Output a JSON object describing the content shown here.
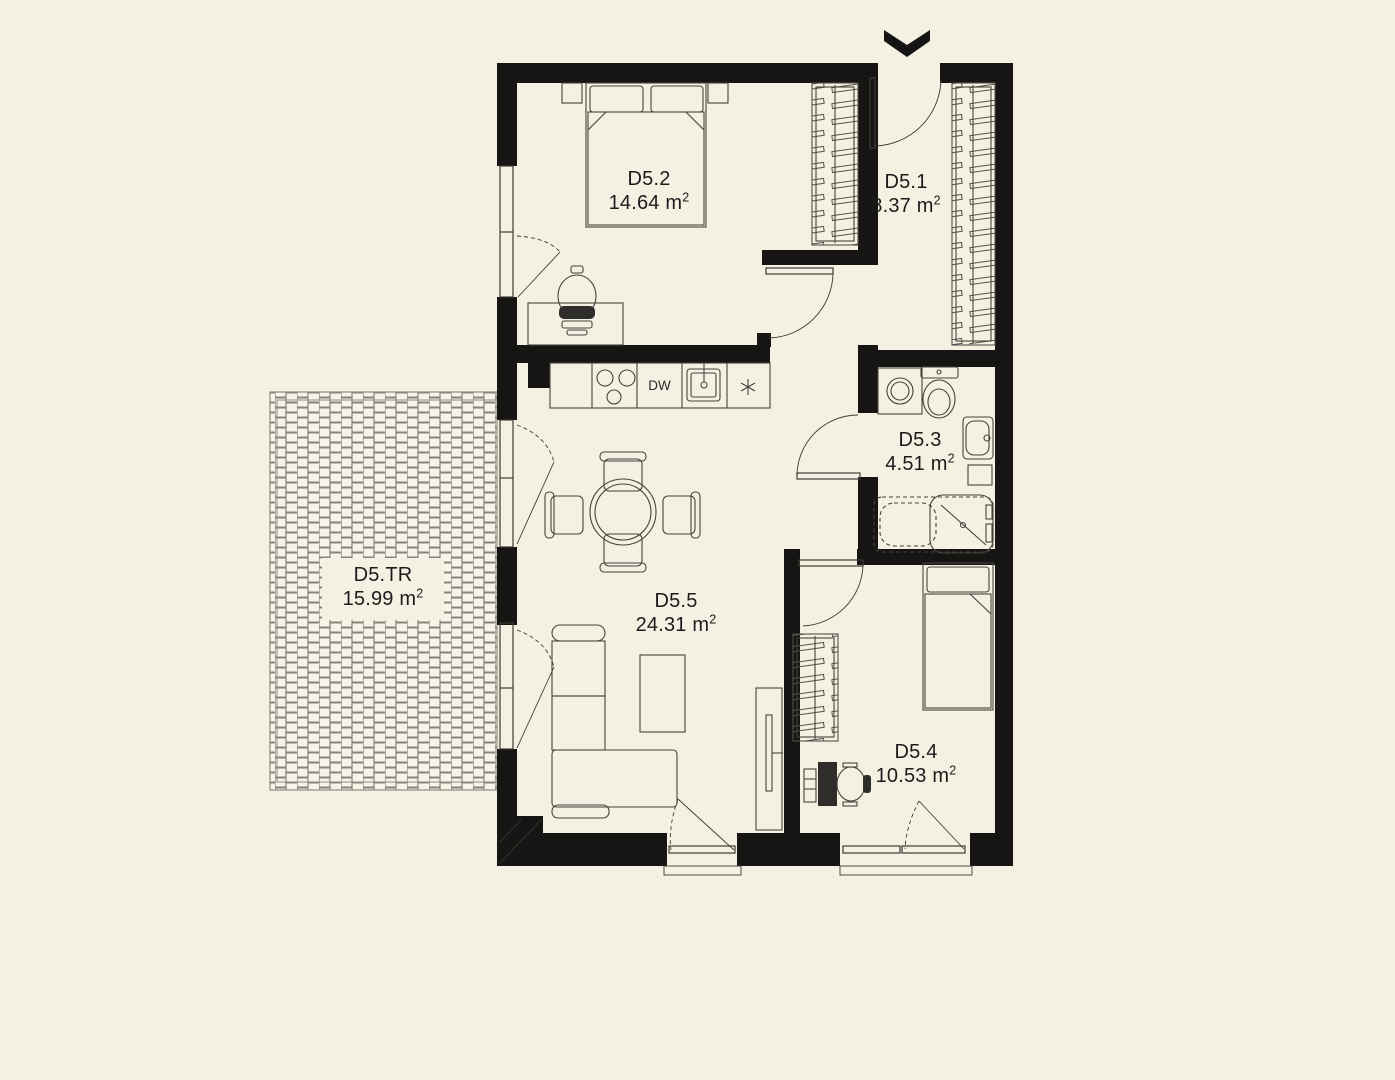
{
  "colors": {
    "background": "#f4f1e3",
    "wall": "#161513",
    "line": "#3d3b35",
    "furniture": "#45433c",
    "text": "#1b1b1b"
  },
  "rooms": [
    {
      "name": "D5.2",
      "area": "14.64 m",
      "area_sup": "2"
    },
    {
      "name": "D5.1",
      "area": "8.37 m",
      "area_sup": "2"
    },
    {
      "name": "D5.3",
      "area": "4.51 m",
      "area_sup": "2"
    },
    {
      "name": "D5.4",
      "area": "10.53 m",
      "area_sup": "2"
    },
    {
      "name": "D5.5",
      "area": "24.31 m",
      "area_sup": "2"
    },
    {
      "name": "D5.TR",
      "area": "15.99 m",
      "area_sup": "2"
    }
  ],
  "kitchen": {
    "dishwasher_label": "DW"
  },
  "icons": {
    "entrance_arrow": "chevron-down",
    "kitchen_point": "asterisk"
  }
}
